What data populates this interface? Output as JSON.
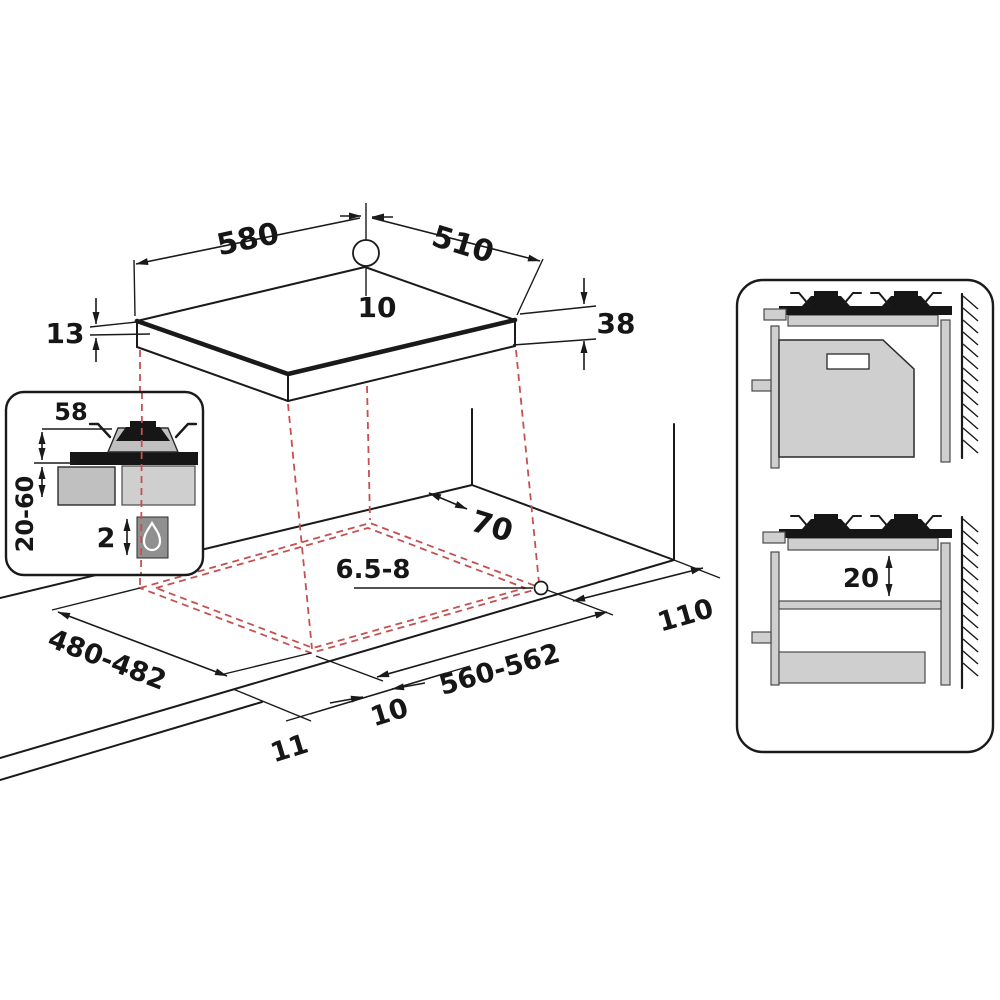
{
  "diagram": {
    "kind": "hob-installation-dimension-diagram",
    "colors": {
      "line": "#1a1a1a",
      "projection_red": "#c4514f",
      "fill_light": "#cfcfcf",
      "fill_mid": "#c0c0c0",
      "fill_dark": "#909090",
      "black_fill": "#161616",
      "background": "#ffffff"
    },
    "dims": {
      "top_width": "580",
      "top_depth": "510",
      "hole_offset": "10",
      "glass_thickness": "13",
      "build_in_height": "38",
      "rear_clearance": "70",
      "hole_diameter": "6.5-8",
      "cutout_depth": "480-482",
      "cutout_width": "560-562",
      "right_clearance": "110",
      "front_gap": "10",
      "front_edge": "11",
      "inset_support_height": "58",
      "inset_worktop_thickness": "20-60",
      "inset_bottom_gap": "2",
      "shelf_clearance": "20"
    },
    "icons": {
      "flame": "flame-drop-icon",
      "burner": "gas-burner-icon",
      "wall": "wall-hatch",
      "hole": "gas-connection-hole"
    }
  }
}
